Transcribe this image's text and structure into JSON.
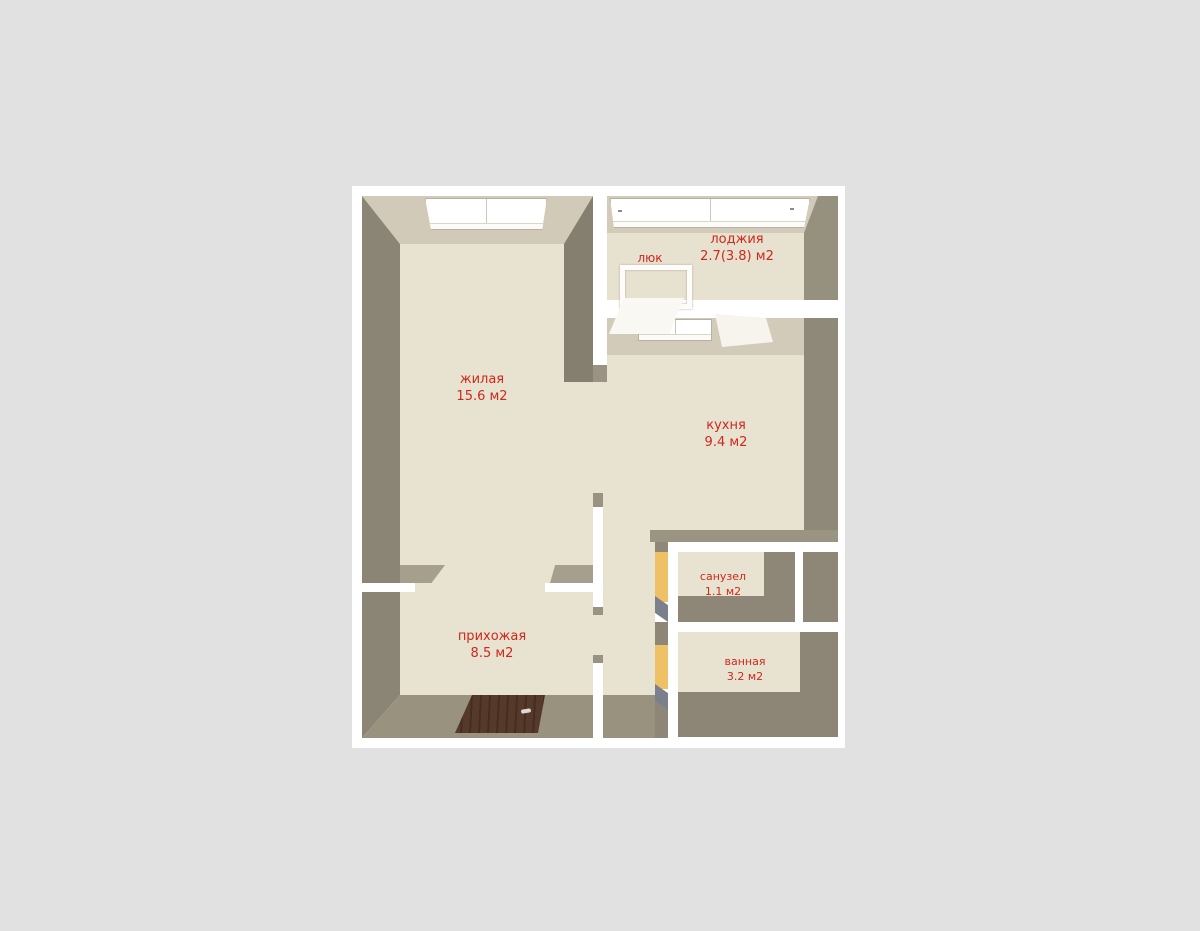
{
  "page": {
    "background_color": "#e1e1e1",
    "plan_background": "#ffffff"
  },
  "plan": {
    "type": "apartment-floor-plan",
    "language": "ru",
    "rooms": {
      "living": {
        "name": "жилая",
        "area": "15.6 м2"
      },
      "loggia": {
        "name": "лоджия",
        "area": "2.7(3.8) м2"
      },
      "kitchen": {
        "name": "кухня",
        "area": "9.4 м2"
      },
      "wc": {
        "name": "санузел",
        "area": "1.1 м2"
      },
      "bath": {
        "name": "ванная",
        "area": "3.2 м2"
      },
      "hall": {
        "name": "прихожая",
        "area": "8.5 м2"
      },
      "hatch": {
        "name": "люк"
      }
    },
    "colors": {
      "label_text": "#d0281c",
      "floor": "#e8e2d0",
      "wall_top_light": "#d1cab8",
      "wall_gray": "#8b8575",
      "wall_dark": "#857f6f",
      "cut_wall_white": "#ffffff",
      "open_door_frame_yellow": "#eec167",
      "entrance_door_wood": "#55392b"
    }
  }
}
